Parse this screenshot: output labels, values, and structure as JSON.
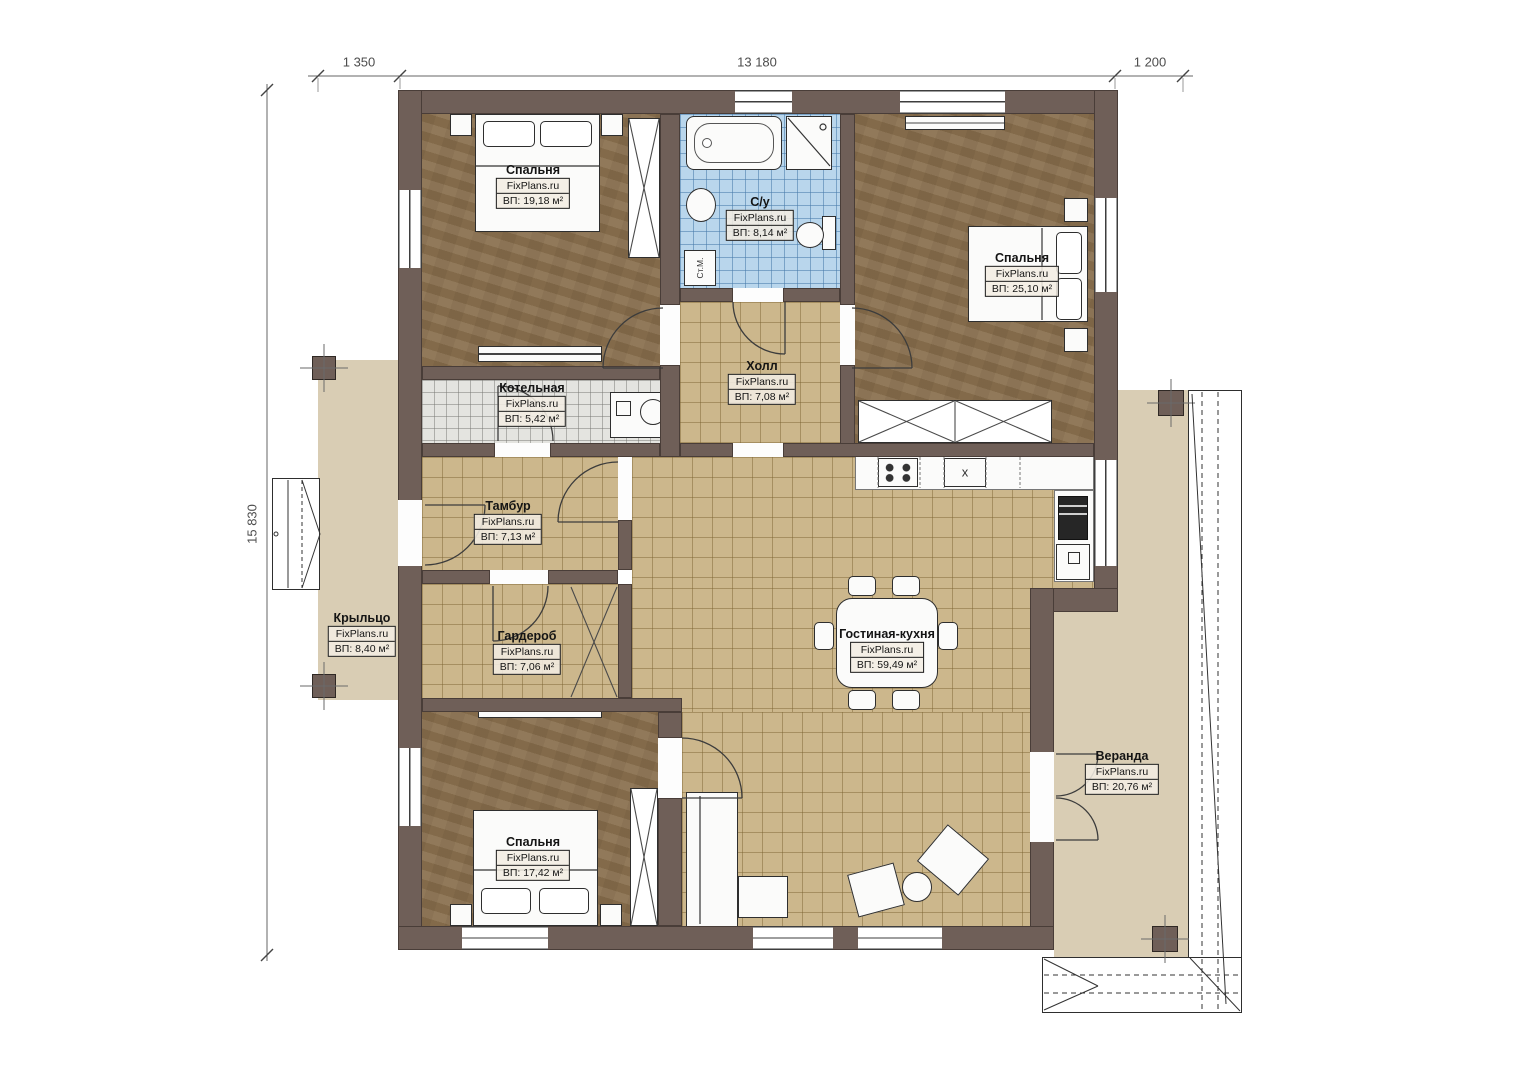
{
  "dimensions": {
    "top": [
      "1 350",
      "13 180",
      "1 200"
    ],
    "left": "15 830"
  },
  "rooms": [
    {
      "id": "bedroom-top-left",
      "name": "Спальня",
      "brand": "FixPlans.ru",
      "area": "ВП: 19,18 м²"
    },
    {
      "id": "bathroom",
      "name": "С/у",
      "brand": "FixPlans.ru",
      "area": "ВП: 8,14 м²"
    },
    {
      "id": "bedroom-top-right",
      "name": "Спальня",
      "brand": "FixPlans.ru",
      "area": "ВП: 25,10 м²"
    },
    {
      "id": "boiler-room",
      "name": "Котельная",
      "brand": "FixPlans.ru",
      "area": "ВП: 5,42 м²"
    },
    {
      "id": "hall",
      "name": "Холл",
      "brand": "FixPlans.ru",
      "area": "ВП: 7,08 м²"
    },
    {
      "id": "vestibule",
      "name": "Тамбур",
      "brand": "FixPlans.ru",
      "area": "ВП: 7,13 м²"
    },
    {
      "id": "wardrobe-room",
      "name": "Гардероб",
      "brand": "FixPlans.ru",
      "area": "ВП: 7,06 м²"
    },
    {
      "id": "porch",
      "name": "Крыльцо",
      "brand": "FixPlans.ru",
      "area": "ВП: 8,40 м²"
    },
    {
      "id": "living-kitchen",
      "name": "Гостиная-кухня",
      "brand": "FixPlans.ru",
      "area": "ВП: 59,49 м²"
    },
    {
      "id": "veranda",
      "name": "Веранда",
      "brand": "FixPlans.ru",
      "area": "ВП: 20,76 м²"
    },
    {
      "id": "bedroom-bottom-left",
      "name": "Спальня",
      "brand": "FixPlans.ru",
      "area": "ВП: 17,42 м²"
    }
  ],
  "annotations": {
    "washing_machine": "Ст.М.",
    "sink_mark": "x"
  },
  "colors": {
    "wall": "#6f5f58",
    "wood": "#8b7251",
    "tile_tan": "#ccb78c",
    "tile_blue": "#b9d6ec",
    "outdoor": "#d9cdb4"
  }
}
